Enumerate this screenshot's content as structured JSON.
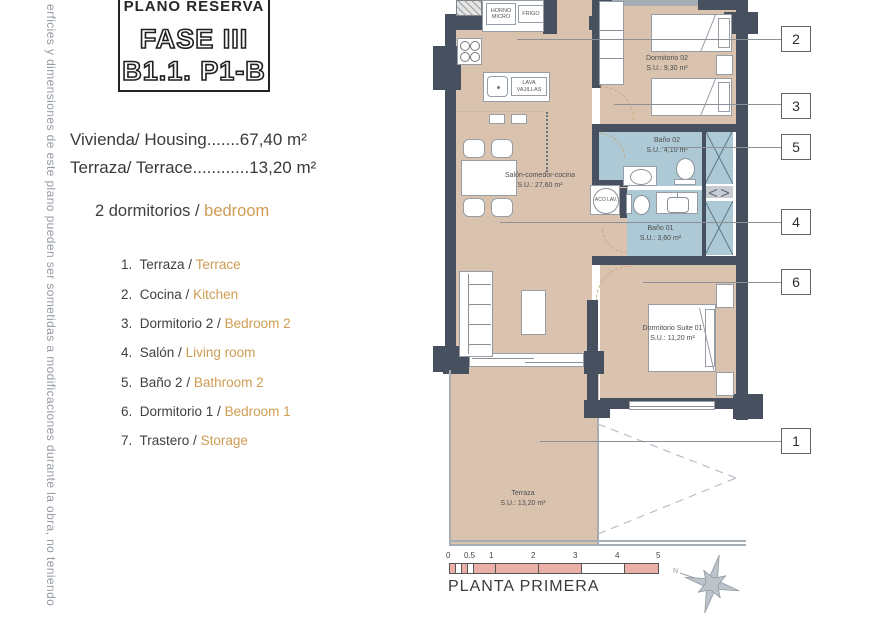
{
  "sidebar": {
    "vertical_note": "erficies y dimensiones de este plano pueden ser sometidas a modificaciones durante la obra, no teniendo",
    "title_box": {
      "heading": "PLANO RESERVA",
      "phase": "FASE III",
      "unit": "B1.1. P1-B"
    },
    "area_lines": [
      "Vivienda/ Housing.......67,40 m²",
      "Terraza/ Terrace............13,20 m²"
    ],
    "bedrooms": {
      "es": "2 dormitorios /",
      "en": "bedroom"
    },
    "legend": [
      {
        "num": "1.",
        "es": "Terraza /",
        "en": "Terrace"
      },
      {
        "num": "2.",
        "es": "Cocina /",
        "en": "Kitchen"
      },
      {
        "num": "3.",
        "es": "Dormitorio 2 /",
        "en": "Bedroom 2"
      },
      {
        "num": "4.",
        "es": "Salón /",
        "en": "Living room"
      },
      {
        "num": "5.",
        "es": "Baño 2 /",
        "en": "Bathroom 2"
      },
      {
        "num": "6.",
        "es": "Dormitorio 1 /",
        "en": "Bedroom 1"
      },
      {
        "num": "7.",
        "es": "Trastero /",
        "en": "Storage"
      }
    ]
  },
  "plan": {
    "rooms": {
      "dorm02": {
        "name": "Dormitorio 02",
        "su": "S.U.: 9,30 m²"
      },
      "bano02": {
        "name": "Baño 02",
        "su": "S.U.: 4,10 m²"
      },
      "bano01": {
        "name": "Baño 01",
        "su": "S.U.: 3,60 m²"
      },
      "salon": {
        "name": "Salón-comedor-cocina",
        "su": "S.U.: 27,60 m²"
      },
      "suite": {
        "name": "Dormitorio Suite 01",
        "su": "S.U.: 11,20 m²"
      },
      "terraza": {
        "name": "Terraza",
        "su": "S.U.: 13,20 m²"
      }
    },
    "appliances": {
      "horno_micro": "HORNO MICRO",
      "frigo": "FRIGO",
      "lavavajillas": "LAVA VAJILLAS",
      "lavadora": "ACO LAV."
    },
    "callouts": [
      "2",
      "3",
      "5",
      "4",
      "6",
      "1"
    ],
    "colors": {
      "wall": "#46505e",
      "floor": "#d9c3af",
      "bath": "#adc9d6",
      "accent": "#cf9c52",
      "scale_pink": "#eaafa7"
    }
  },
  "footer": {
    "scale_ticks": [
      "0",
      "0.5",
      "1",
      "2",
      "3",
      "4",
      "5"
    ],
    "plan_title": "PLANTA PRIMERA",
    "compass": "N"
  }
}
